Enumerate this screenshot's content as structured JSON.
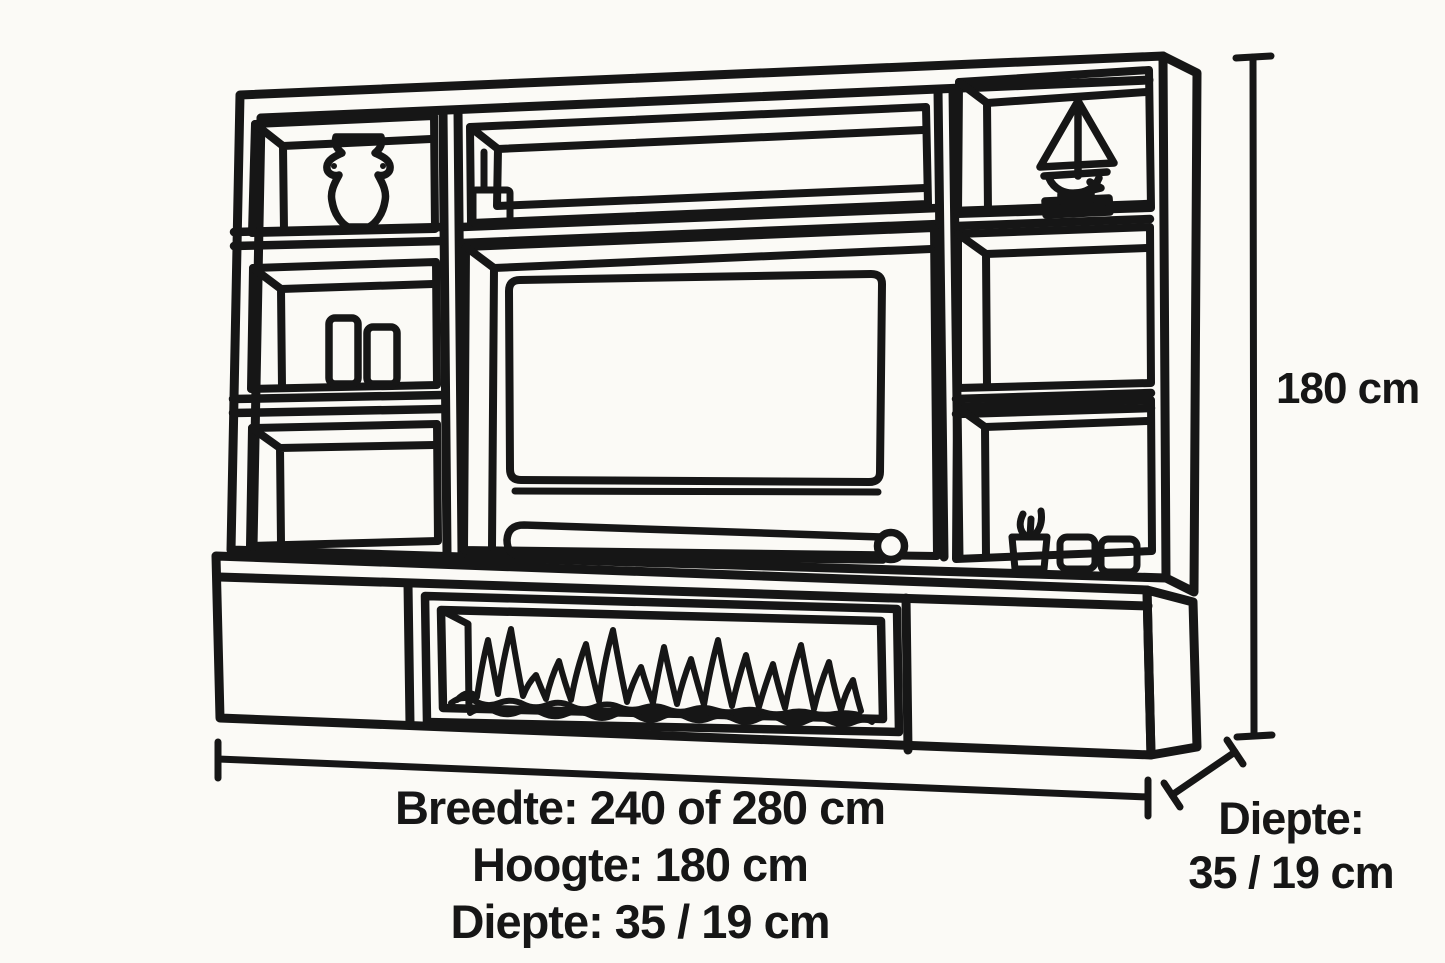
{
  "page": {
    "background_color": "#fbfaf6",
    "line_color": "#161616",
    "text_color": "#161616"
  },
  "dimensions": {
    "bottom_block": {
      "line1": "Breedte: 240 of 280 cm",
      "line2": "Hoogte: 180 cm",
      "line3": "Diepte: 35 / 19 cm"
    },
    "height_label": "180 cm",
    "depth_block": {
      "line1": "Diepte:",
      "line2": "35 / 19 cm"
    }
  },
  "icons": [
    "vase-icon",
    "books-icon",
    "storage-box-icon",
    "sailboat-icon",
    "plant-pot-icon",
    "candle-cups-icon",
    "tv-icon",
    "soundbar-icon",
    "fireplace-flames-icon",
    "width-dimension-line",
    "height-dimension-line",
    "depth-dimension-line"
  ]
}
